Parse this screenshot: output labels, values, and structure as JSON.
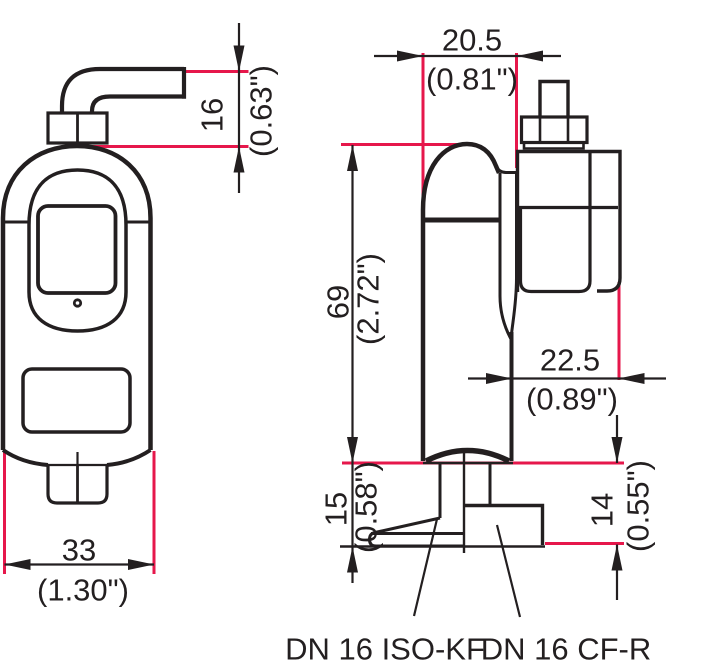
{
  "colors": {
    "ink": "#231f20",
    "dimension_red": "#e6174b",
    "background": "#ffffff"
  },
  "dimensions": {
    "cable_offset": {
      "mm": "16",
      "inch": "(0.63\")"
    },
    "head_width": {
      "mm": "20.5",
      "inch": "(0.81\")"
    },
    "body_height": {
      "mm": "69",
      "inch": "(2.72\")"
    },
    "connector_length": {
      "mm": "22.5",
      "inch": "(0.89\")"
    },
    "body_width": {
      "mm": "33",
      "inch": "(1.30\")"
    },
    "kf_flange_height": {
      "mm": "15",
      "inch": "(0.58\")"
    },
    "cf_flange_height": {
      "mm": "14",
      "inch": "(0.55\")"
    }
  },
  "labels": {
    "iso_kf": "DN 16 ISO-KF",
    "cf_r": "DN 16 CF-R"
  }
}
